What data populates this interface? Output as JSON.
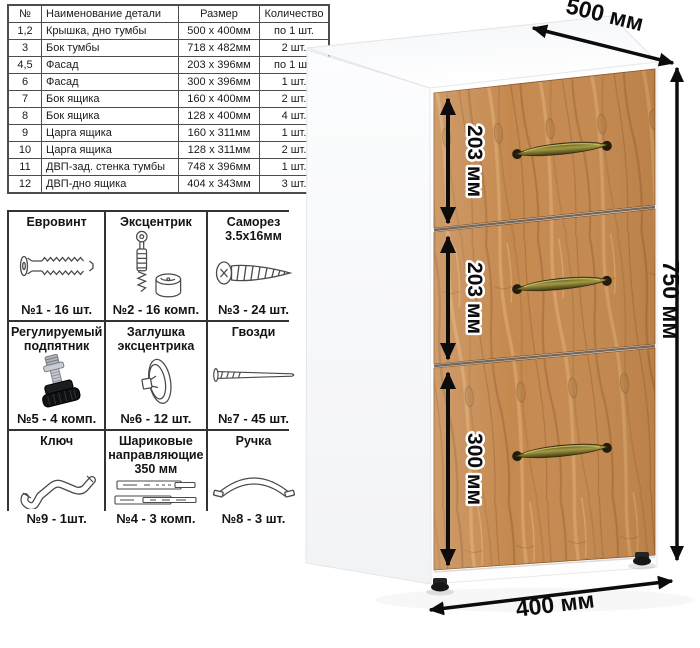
{
  "parts_table": {
    "headers": {
      "num": "№",
      "name": "Наименование детали",
      "size": "Размер",
      "qty": "Количество"
    },
    "rows": [
      {
        "num": "1,2",
        "name": "Крышка, дно тумбы",
        "size": "500 х 400мм",
        "qty": "по 1 шт."
      },
      {
        "num": "3",
        "name": "Бок тумбы",
        "size": "718 х 482мм",
        "qty": "2 шт."
      },
      {
        "num": "4,5",
        "name": "Фасад",
        "size": "203 х 396мм",
        "qty": "по 1 шт."
      },
      {
        "num": "6",
        "name": "Фасад",
        "size": "300 х 396мм",
        "qty": "1 шт."
      },
      {
        "num": "7",
        "name": "Бок ящика",
        "size": "160 х 400мм",
        "qty": "2 шт."
      },
      {
        "num": "8",
        "name": "Бок ящика",
        "size": "128 х 400мм",
        "qty": "4 шт."
      },
      {
        "num": "9",
        "name": "Царга ящика",
        "size": "160 х 311мм",
        "qty": "1 шт."
      },
      {
        "num": "10",
        "name": "Царга ящика",
        "size": "128 х 311мм",
        "qty": "2 шт."
      },
      {
        "num": "11",
        "name": "ДВП-зад. стенка тумбы",
        "size": "748 х 396мм",
        "qty": "1 шт."
      },
      {
        "num": "12",
        "name": "ДВП-дно ящика",
        "size": "404 х 343мм",
        "qty": "3 шт."
      }
    ]
  },
  "hardware": {
    "cells": [
      {
        "title": "Евровинт",
        "qty": "№1 - 16 шт.",
        "icon": "euro-screw-icon"
      },
      {
        "title": "Эксцентрик",
        "qty": "№2 - 16 комп.",
        "icon": "cam-lock-icon"
      },
      {
        "title": "Саморез 3.5х16мм",
        "qty": "№3 - 24 шт.",
        "icon": "self-tapping-screw-icon"
      },
      {
        "title": "Регулируемый подпятник",
        "qty": "№5 - 4 комп.",
        "icon": "adjustable-foot-icon"
      },
      {
        "title": "Заглушка эксцентрика",
        "qty": "№6 - 12 шт.",
        "icon": "cam-cover-icon"
      },
      {
        "title": "Гвозди",
        "qty": "№7 - 45 шт.",
        "icon": "nail-icon"
      },
      {
        "title": "Ключ",
        "qty": "№9 - 1шт.",
        "icon": "hex-key-icon"
      },
      {
        "title": "Шариковые направляющие 350 мм",
        "qty": "№4 - 3 комп.",
        "icon": "ball-slides-icon"
      },
      {
        "title": "Ручка",
        "qty": "№8 - 3 шт.",
        "icon": "bow-handle-icon"
      }
    ]
  },
  "cabinet": {
    "dims": {
      "depth": "500 мм",
      "height": "750 мм",
      "width": "400 мм"
    },
    "drawers": [
      {
        "label": "203 мм"
      },
      {
        "label": "203 мм"
      },
      {
        "label": "300 мм"
      }
    ],
    "colors": {
      "wood_base": "#c5894f",
      "wood_dark": "#9a6434",
      "wood_light": "#d9a268",
      "handle_brass": "#8c8433",
      "carcass": "#ffffff",
      "dimension": "#0c0c0c"
    }
  }
}
